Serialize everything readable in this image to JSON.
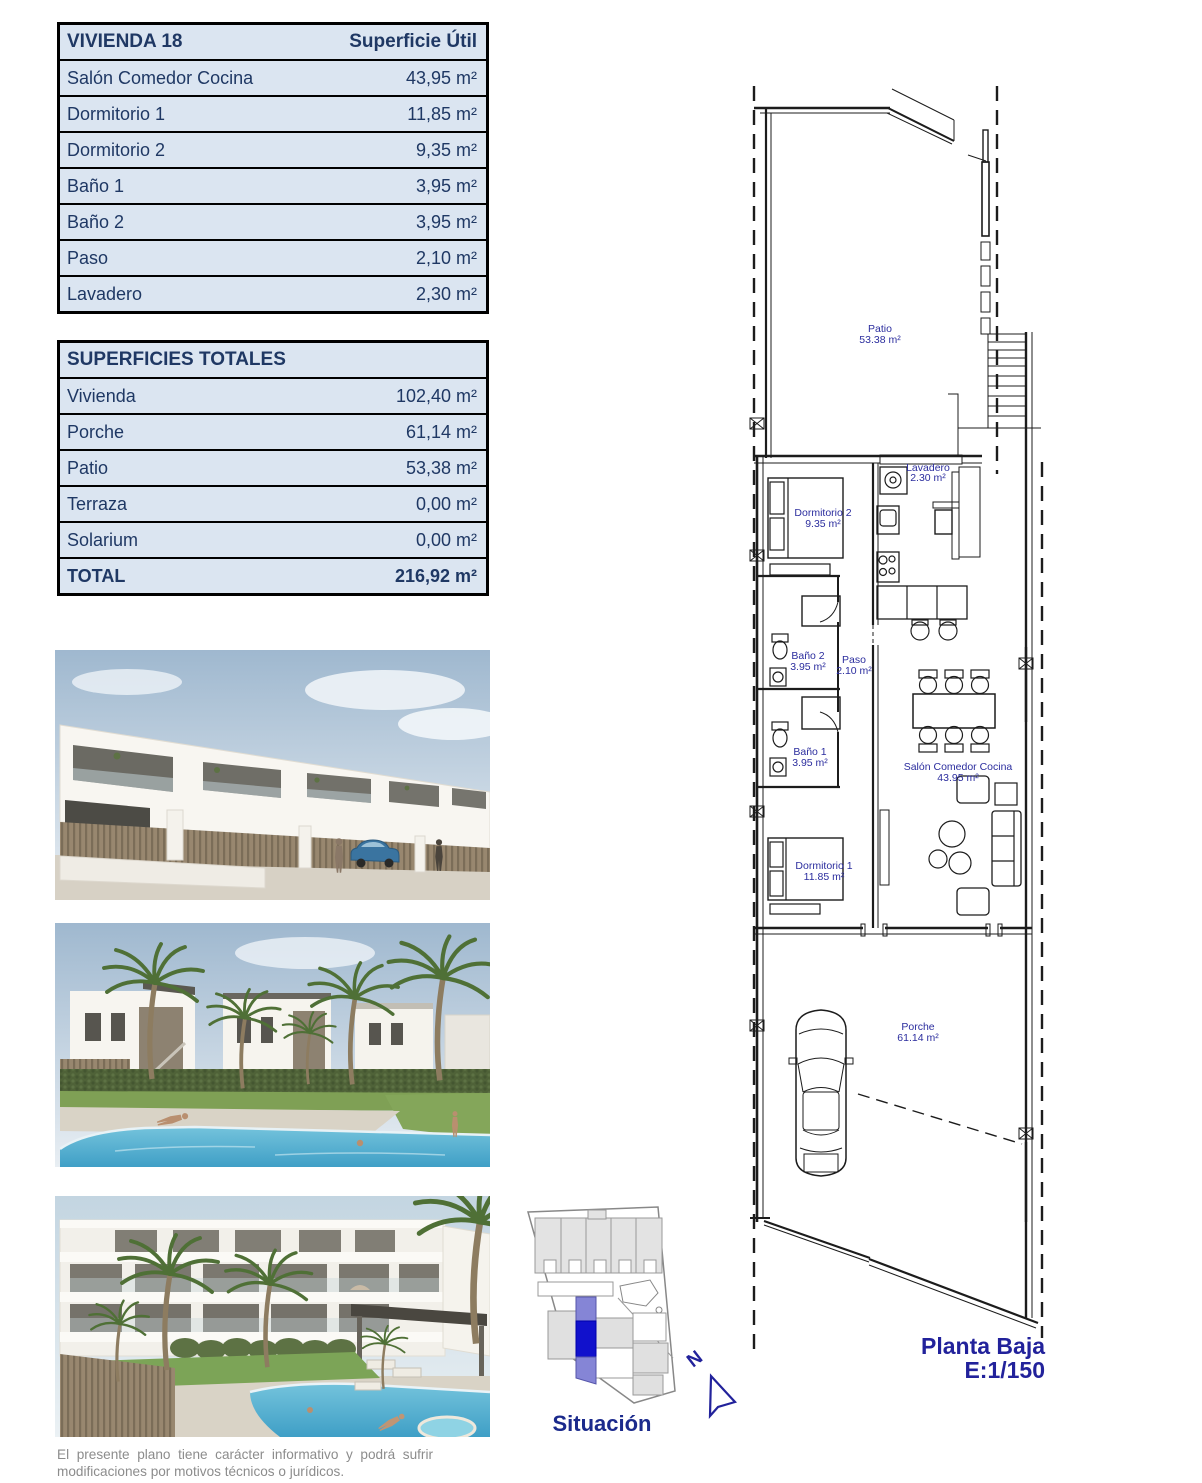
{
  "table_vivienda": {
    "title": "VIVIENDA 18",
    "column_header": "Superficie Útil",
    "rows": [
      {
        "label": "Salón Comedor Cocina",
        "value": "43,95 m²"
      },
      {
        "label": "Dormitorio 1",
        "value": "11,85 m²"
      },
      {
        "label": "Dormitorio 2",
        "value": "9,35 m²"
      },
      {
        "label": "Baño 1",
        "value": "3,95 m²"
      },
      {
        "label": "Baño 2",
        "value": "3,95 m²"
      },
      {
        "label": "Paso",
        "value": "2,10 m²"
      },
      {
        "label": "Lavadero",
        "value": "2,30 m²"
      }
    ]
  },
  "table_totales": {
    "title": "SUPERFICIES TOTALES",
    "rows": [
      {
        "label": "Vivienda",
        "value": "102,40 m²"
      },
      {
        "label": "Porche",
        "value": "61,14 m²"
      },
      {
        "label": "Patio",
        "value": "53,38 m²"
      },
      {
        "label": "Terraza",
        "value": "0,00 m²"
      },
      {
        "label": "Solarium",
        "value": "0,00 m²"
      }
    ],
    "total": {
      "label": "TOTAL",
      "value": "216,92 m²"
    }
  },
  "floor_plan": {
    "labels": {
      "patio": {
        "name": "Patio",
        "area": "53.38 m²"
      },
      "lavadero": {
        "name": "Lavadero",
        "area": "2.30 m²"
      },
      "dormitorio2": {
        "name": "Dormitorio 2",
        "area": "9.35 m²"
      },
      "bano2": {
        "name": "Baño 2",
        "area": "3.95 m²"
      },
      "paso": {
        "name": "Paso",
        "area": "2.10 m²"
      },
      "salon": {
        "name": "Salón Comedor Cocina",
        "area": "43.95 m²"
      },
      "bano1": {
        "name": "Baño 1",
        "area": "3.95 m²"
      },
      "dormitorio1": {
        "name": "Dormitorio 1",
        "area": "11.85 m²"
      },
      "porche": {
        "name": "Porche",
        "area": "61.14 m²"
      }
    },
    "caption": {
      "line1": "Planta Baja",
      "line2": "E:1/150"
    }
  },
  "site_map": {
    "label": "Situación",
    "compass_letter": "N"
  },
  "disclaimer": {
    "line1": "El presente plano tiene carácter informativo y podrá sufrir",
    "line2": "modificaciones por motivos técnicos o jurídicos."
  },
  "colors": {
    "table_bg": "#dbe5f1",
    "table_text": "#1f3864",
    "plan_label": "#2b2d9e",
    "caption_text": "#22229b",
    "site_highlight": "#1111cc",
    "site_highlight_light": "#8585d6"
  }
}
